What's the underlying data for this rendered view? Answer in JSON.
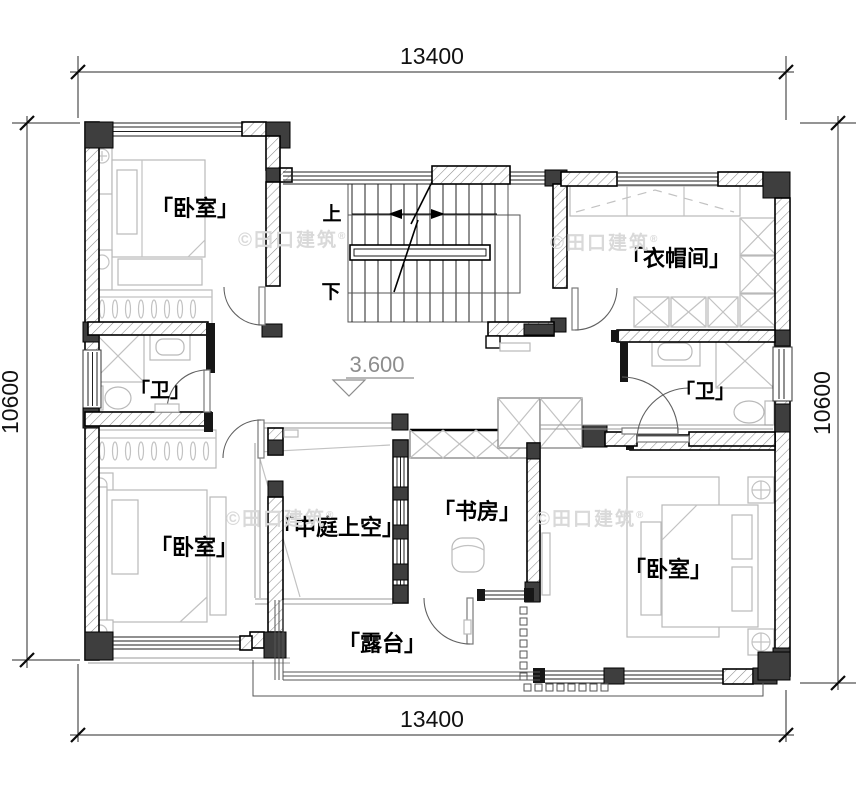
{
  "dimensions": {
    "top": "13400",
    "bottom": "13400",
    "left": "10600",
    "right": "10600"
  },
  "elevation_marker": {
    "value": "3.600"
  },
  "stair_labels": {
    "up": "上",
    "down": "下"
  },
  "rooms": [
    {
      "id": "bedroom-top-left",
      "label": "「卧室」"
    },
    {
      "id": "cloakroom",
      "label": "「衣帽间」"
    },
    {
      "id": "bath-left",
      "label": "「卫」"
    },
    {
      "id": "bath-right",
      "label": "「卫」"
    },
    {
      "id": "bedroom-bottom-left",
      "label": "「卧室」"
    },
    {
      "id": "atrium-void",
      "label": "「中庭上空」"
    },
    {
      "id": "study",
      "label": "「书房」"
    },
    {
      "id": "bedroom-bottom-right",
      "label": "「卧室」"
    },
    {
      "id": "terrace",
      "label": "「露台」"
    }
  ],
  "watermark": {
    "text": "©田口建筑",
    "reg": "®"
  },
  "colors": {
    "wall_fill_dark": "#3e3e3e",
    "linework": "#000000",
    "furniture_line": "#c2c2c2",
    "watermark": "#d9d9d9"
  }
}
